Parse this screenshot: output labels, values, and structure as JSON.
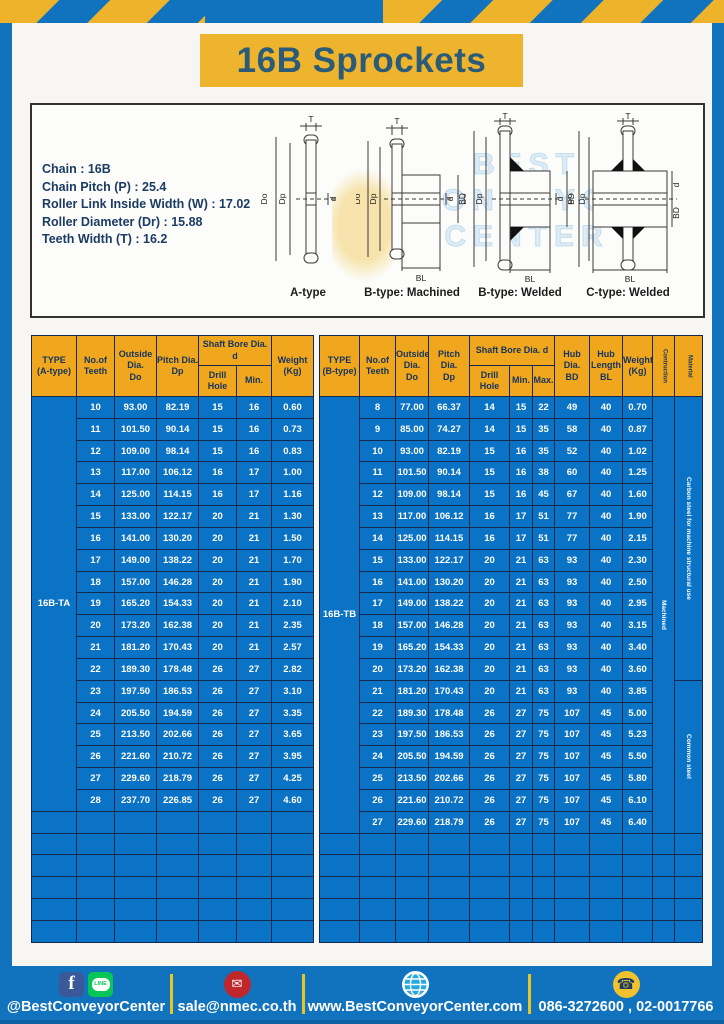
{
  "page": {
    "title": "16B Sprockets"
  },
  "specs": {
    "lines": [
      "Chain : 16B",
      "Chain Pitch (P) : 25.4",
      "Roller Link Inside Width (W) : 17.02",
      "Roller Diameter (Dr) : 15.88",
      "Teeth Width (T) : 16.2"
    ]
  },
  "diagrams": {
    "labels": {
      "t": "T",
      "outside": "Do",
      "pitch": "Dp",
      "bore": "d",
      "hub_dia": "BD",
      "hub_len": "BL"
    },
    "captions": [
      "A-type",
      "B-type: Machined",
      "B-type: Welded",
      "C-type: Welded"
    ],
    "watermark": [
      "BEST",
      "CONVEYOR",
      "CENTER"
    ]
  },
  "table_a": {
    "type_label": "16B-TA",
    "head": {
      "type": [
        "TYPE",
        "(A-type)"
      ],
      "teeth": [
        "No.of",
        "Teeth"
      ],
      "outside": [
        "Outside",
        "Dia.",
        "Do"
      ],
      "pitch": [
        "Pitch Dia.",
        "Dp"
      ],
      "shaft_bore": "Shaft Bore Dia. d",
      "drill": "Drill Hole",
      "min": "Min.",
      "weight": [
        "Weight",
        "(Kg)"
      ]
    },
    "rows": [
      [
        "10",
        "93.00",
        "82.19",
        "15",
        "16",
        "0.60"
      ],
      [
        "11",
        "101.50",
        "90.14",
        "15",
        "16",
        "0.73"
      ],
      [
        "12",
        "109.00",
        "98.14",
        "15",
        "16",
        "0.83"
      ],
      [
        "13",
        "117.00",
        "106.12",
        "16",
        "17",
        "1.00"
      ],
      [
        "14",
        "125.00",
        "114.15",
        "16",
        "17",
        "1.16"
      ],
      [
        "15",
        "133.00",
        "122.17",
        "20",
        "21",
        "1.30"
      ],
      [
        "16",
        "141.00",
        "130.20",
        "20",
        "21",
        "1.50"
      ],
      [
        "17",
        "149.00",
        "138.22",
        "20",
        "21",
        "1.70"
      ],
      [
        "18",
        "157.00",
        "146.28",
        "20",
        "21",
        "1.90"
      ],
      [
        "19",
        "165.20",
        "154.33",
        "20",
        "21",
        "2.10"
      ],
      [
        "20",
        "173.20",
        "162.38",
        "20",
        "21",
        "2.35"
      ],
      [
        "21",
        "181.20",
        "170.43",
        "20",
        "21",
        "2.57"
      ],
      [
        "22",
        "189.30",
        "178.48",
        "26",
        "27",
        "2.82"
      ],
      [
        "23",
        "197.50",
        "186.53",
        "26",
        "27",
        "3.10"
      ],
      [
        "24",
        "205.50",
        "194.59",
        "26",
        "27",
        "3.35"
      ],
      [
        "25",
        "213.50",
        "202.66",
        "26",
        "27",
        "3.65"
      ],
      [
        "26",
        "221.60",
        "210.72",
        "26",
        "27",
        "3.95"
      ],
      [
        "27",
        "229.60",
        "218.79",
        "26",
        "27",
        "4.25"
      ],
      [
        "28",
        "237.70",
        "226.85",
        "26",
        "27",
        "4.60"
      ]
    ],
    "empty_rows": 6
  },
  "table_b": {
    "type_label": "16B-TB",
    "head": {
      "type": [
        "TYPE",
        "(B-type)"
      ],
      "teeth": [
        "No.of",
        "Teeth"
      ],
      "outside": [
        "Outside",
        "Dia.",
        "Do"
      ],
      "pitch": [
        "Pitch Dia.",
        "Dp"
      ],
      "shaft_bore": "Shaft Bore Dia. d",
      "drill": "Drill Hole",
      "min": "Min.",
      "max": "Max.",
      "hub_dia": [
        "Hub Dia.",
        "BD"
      ],
      "hub_len": [
        "Hub",
        "Length",
        "BL"
      ],
      "weight": [
        "Weight",
        "(Kg)"
      ],
      "construction": "Contruction",
      "material": "Material"
    },
    "rows": [
      [
        "8",
        "77.00",
        "66.37",
        "14",
        "15",
        "22",
        "49",
        "40",
        "0.70"
      ],
      [
        "9",
        "85.00",
        "74.27",
        "14",
        "15",
        "35",
        "58",
        "40",
        "0.87"
      ],
      [
        "10",
        "93.00",
        "82.19",
        "15",
        "16",
        "35",
        "52",
        "40",
        "1.02"
      ],
      [
        "11",
        "101.50",
        "90.14",
        "15",
        "16",
        "38",
        "60",
        "40",
        "1.25"
      ],
      [
        "12",
        "109.00",
        "98.14",
        "15",
        "16",
        "45",
        "67",
        "40",
        "1.60"
      ],
      [
        "13",
        "117.00",
        "106.12",
        "16",
        "17",
        "51",
        "77",
        "40",
        "1.90"
      ],
      [
        "14",
        "125.00",
        "114.15",
        "16",
        "17",
        "51",
        "77",
        "40",
        "2.15"
      ],
      [
        "15",
        "133.00",
        "122.17",
        "20",
        "21",
        "63",
        "93",
        "40",
        "2.30"
      ],
      [
        "16",
        "141.00",
        "130.20",
        "20",
        "21",
        "63",
        "93",
        "40",
        "2.50"
      ],
      [
        "17",
        "149.00",
        "138.22",
        "20",
        "21",
        "63",
        "93",
        "40",
        "2.95"
      ],
      [
        "18",
        "157.00",
        "146.28",
        "20",
        "21",
        "63",
        "93",
        "40",
        "3.15"
      ],
      [
        "19",
        "165.20",
        "154.33",
        "20",
        "21",
        "63",
        "93",
        "40",
        "3.40"
      ],
      [
        "20",
        "173.20",
        "162.38",
        "20",
        "21",
        "63",
        "93",
        "40",
        "3.60"
      ],
      [
        "21",
        "181.20",
        "170.43",
        "20",
        "21",
        "63",
        "93",
        "40",
        "3.85"
      ],
      [
        "22",
        "189.30",
        "178.48",
        "26",
        "27",
        "75",
        "107",
        "45",
        "5.00"
      ],
      [
        "23",
        "197.50",
        "186.53",
        "26",
        "27",
        "75",
        "107",
        "45",
        "5.23"
      ],
      [
        "24",
        "205.50",
        "194.59",
        "26",
        "27",
        "75",
        "107",
        "45",
        "5.50"
      ],
      [
        "25",
        "213.50",
        "202.66",
        "26",
        "27",
        "75",
        "107",
        "45",
        "5.80"
      ],
      [
        "26",
        "221.60",
        "210.72",
        "26",
        "27",
        "75",
        "107",
        "45",
        "6.10"
      ],
      [
        "27",
        "229.60",
        "218.79",
        "26",
        "27",
        "75",
        "107",
        "45",
        "6.40"
      ]
    ],
    "empty_rows": 5,
    "construction_value": "Machined",
    "materials": [
      {
        "label": "Carbon steel for machine structural use",
        "span": 13
      },
      {
        "label": "Common steel",
        "span": 7
      }
    ]
  },
  "footer": {
    "line_badge": "LINE",
    "facebook_letter": "f",
    "items": [
      {
        "text": "@BestConveyorCenter"
      },
      {
        "text": "sale@nmec.co.th"
      },
      {
        "text": "www.BestConveyorCenter.com"
      },
      {
        "text": "086-3272600 , 02-0017766"
      }
    ]
  },
  "colors": {
    "frame_blue": "#1173BD",
    "cell_blue": "#0B73C5",
    "header_yellow": "#F0A71D",
    "banner_yellow": "#EFB42D",
    "stripe_yellow": "#EDB32B",
    "border_navy": "#13294D",
    "text_navy": "#1B3C63",
    "email_red": "#C0272D",
    "line_green": "#06C755",
    "facebook_blue": "#3B5998",
    "globe_blue": "#29A8E0",
    "phone_yellow": "#F2C12E"
  }
}
